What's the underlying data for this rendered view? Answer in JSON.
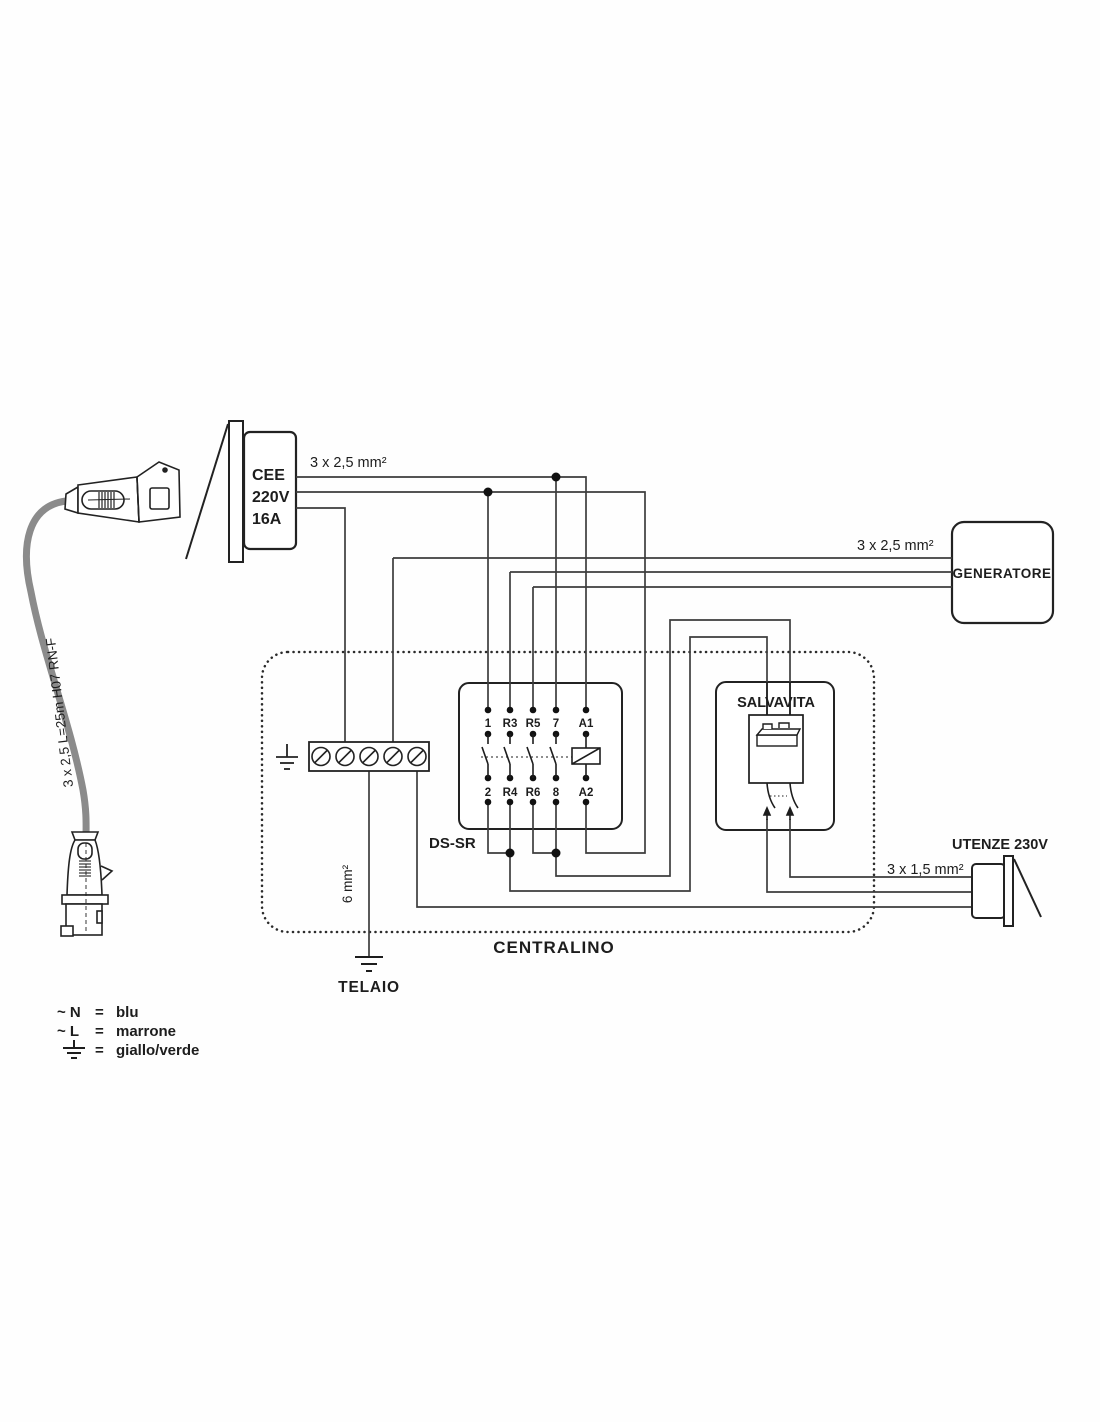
{
  "labels": {
    "supply_cable_spec": "3 x 2,5 mm²",
    "cee_line1": "CEE",
    "cee_line2": "220V",
    "cee_line3": "16A",
    "flex_cable_spec": "3 x 2,5  L=25m  H07 RN-F",
    "generator": "GENERATORE",
    "generator_cable_spec": "3 x 2,5 mm²",
    "centralino": "CENTRALINO",
    "dssr": "DS-SR",
    "salvavita": "SALVAVITA",
    "telaio": "TELAIO",
    "ground_cable_spec": "6 mm²",
    "utenze": "UTENZE 230V",
    "utenze_cable_spec": "3 x 1,5 mm²"
  },
  "dssr_terminals": {
    "top": [
      "1",
      "R3",
      "R5",
      "7",
      "A1"
    ],
    "bottom": [
      "2",
      "R4",
      "R6",
      "8",
      "A2"
    ]
  },
  "legend": {
    "rows": [
      {
        "symbol": "~ N",
        "eq": "=",
        "value": "blu"
      },
      {
        "symbol": "~ L",
        "eq": "=",
        "value": "marrone"
      },
      {
        "symbol": "earth-ground-icon",
        "eq": "=",
        "value": "giallo/verde"
      }
    ]
  },
  "colors": {
    "ink": "#1d1d1d",
    "wire": "#3d3d3d",
    "cable_gray": "#8b8b8b"
  }
}
